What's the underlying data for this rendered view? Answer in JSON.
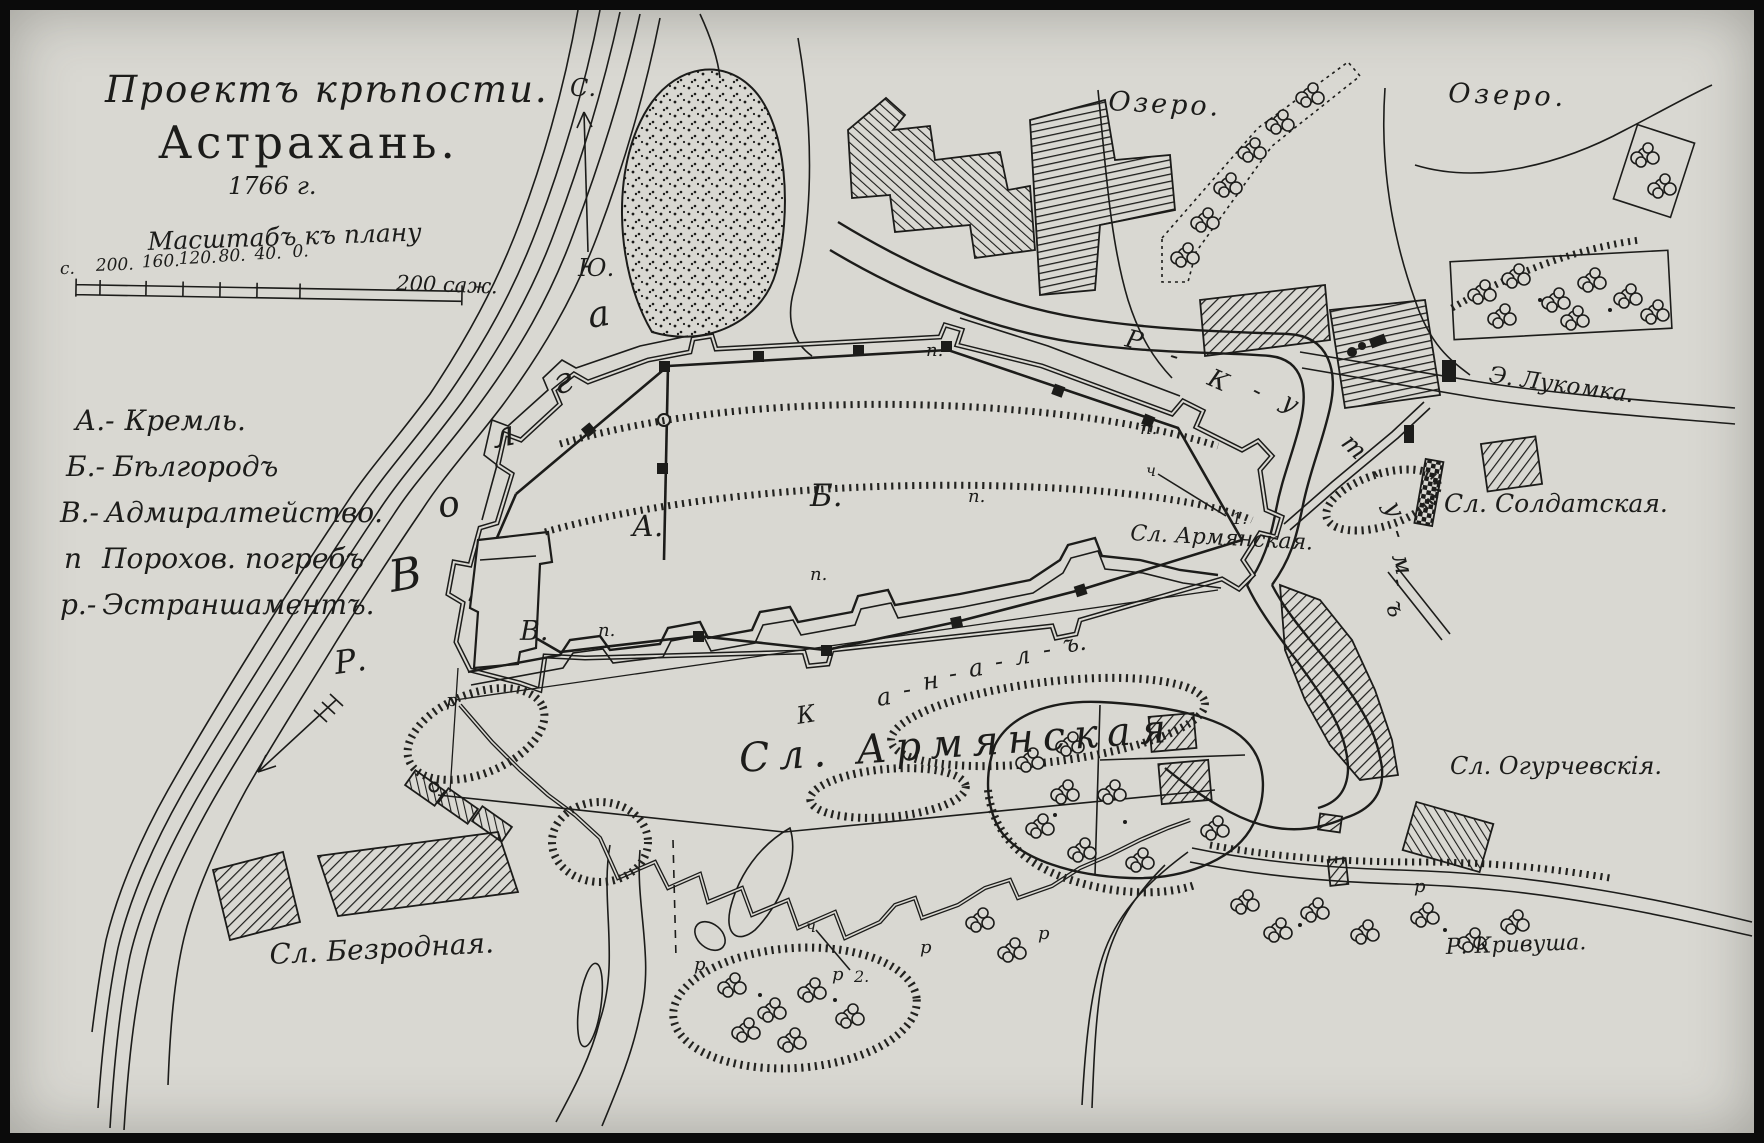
{
  "colors": {
    "paper": "#d9d8d2",
    "ink": "#1c1c1a"
  },
  "title": {
    "line1": "Проектъ крѣпости.",
    "line2": "Астрахань.",
    "year": "1766 г."
  },
  "compass": {
    "north": "С.",
    "south": "Ю."
  },
  "scale_bar": {
    "caption": "Масштабъ къ плану",
    "ticks": [
      "с.",
      "200.",
      "160.",
      "120.",
      "80.",
      "40.",
      "0."
    ],
    "extent": "200 саж."
  },
  "legend": {
    "items": [
      {
        "key": "А.-",
        "label": "Кремль."
      },
      {
        "key": "Б.-",
        "label": "Бѣлгородъ"
      },
      {
        "key": "В.-",
        "label": "Адмиралтейство."
      },
      {
        "key": "п",
        "label": "Порохов. погребъ"
      },
      {
        "key": "р.-",
        "label": "Эстраншаментъ."
      }
    ]
  },
  "water": {
    "volga_prefix": "Р.",
    "volga_letters": [
      "В",
      "о",
      "л",
      "г",
      "а"
    ],
    "kutum_letters": [
      "Р",
      "-",
      "К",
      "-",
      "у",
      "т",
      "-",
      "у",
      "-",
      "м",
      "-",
      "ъ"
    ],
    "canal_letters": [
      "К",
      "а",
      "-",
      "н",
      "-",
      "а",
      "-",
      "л",
      "-",
      "ъ."
    ],
    "lukomka": "Э. Лукомка.",
    "krivusha": "Р. Кривуша.",
    "lake_left": "Озеро.",
    "lake_right": "Озеро."
  },
  "places": {
    "kremlin": "А.",
    "belgorod": "Б.",
    "admiralty": "В.",
    "soldatskaya": "Сл. Солдатская.",
    "armyanskaya": "Сл. Армянская.",
    "armyanskaya_big": "Сл. Армянская",
    "ogurchevskaya": "Сл. Огурчевскія.",
    "bezrodnaya": "Сл. Безродная."
  },
  "markers": {
    "powder": "п.",
    "retrench": "р",
    "redoubt": "ч",
    "ref1": "1.",
    "ref2": "2."
  }
}
